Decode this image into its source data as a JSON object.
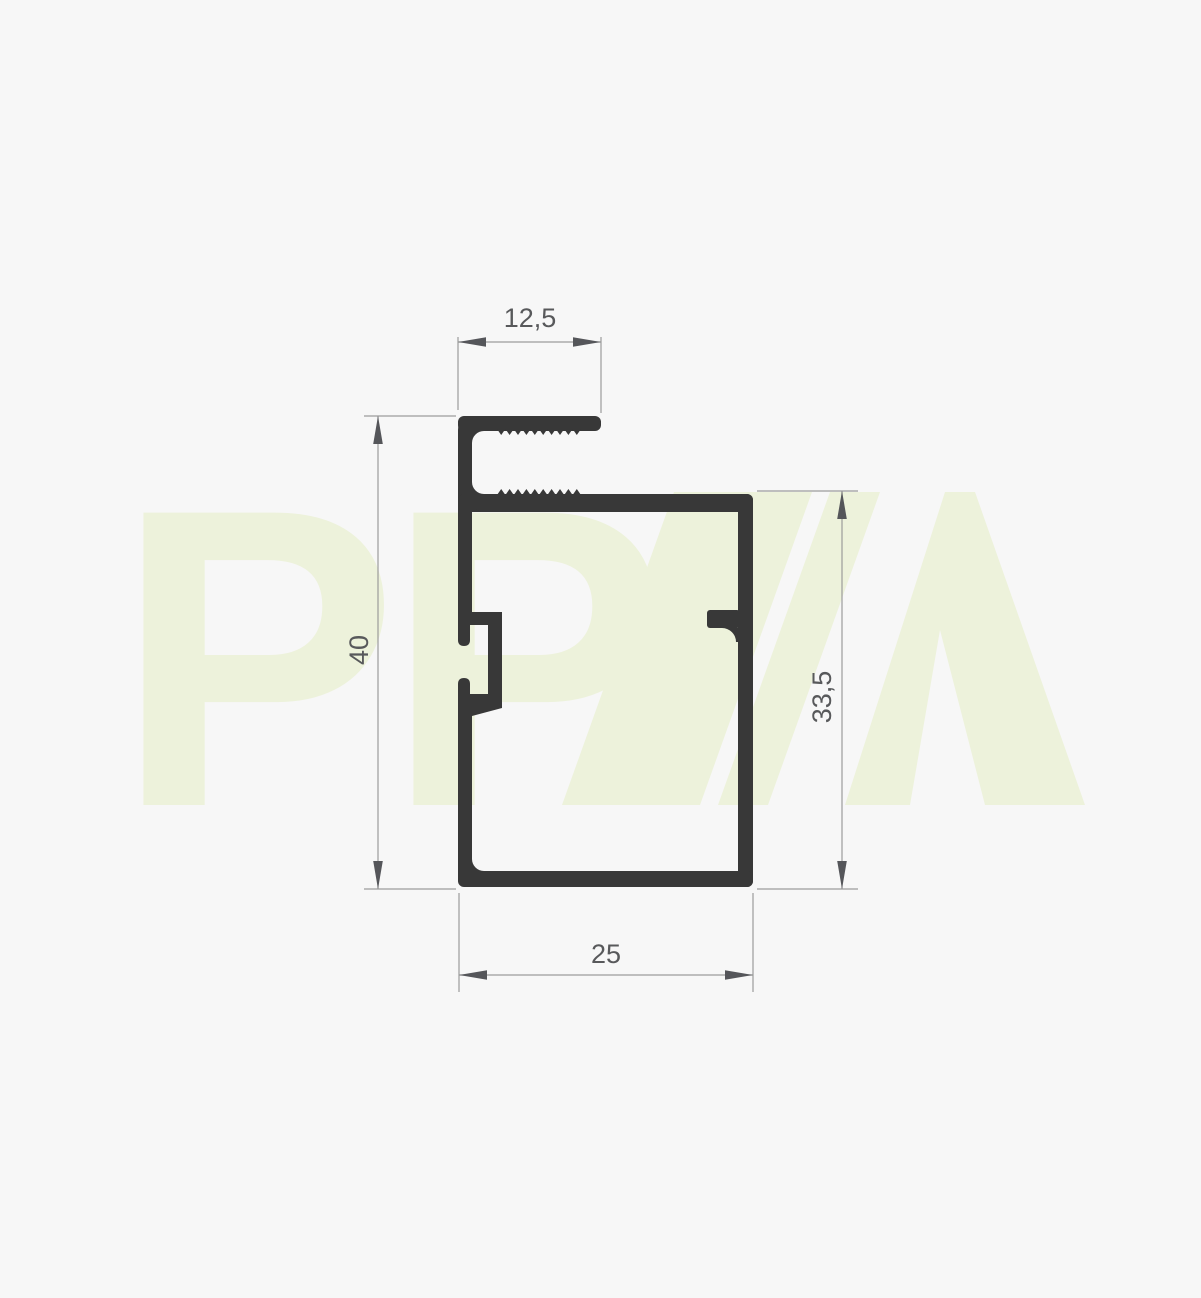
{
  "page": {
    "background_color": "#f7f7f7"
  },
  "drawing": {
    "profile_color": "#383838",
    "line_color": "#9b9b9b",
    "arrow_color": "#55565a",
    "text_color": "#58595b",
    "dimensions": {
      "top_width": "12,5",
      "overall_height": "40",
      "inner_height": "33,5",
      "bottom_width": "25"
    }
  },
  "watermark": {
    "color": "#edf2db",
    "letter_first": "P",
    "letter_second": "P",
    "letter_third": "A"
  }
}
